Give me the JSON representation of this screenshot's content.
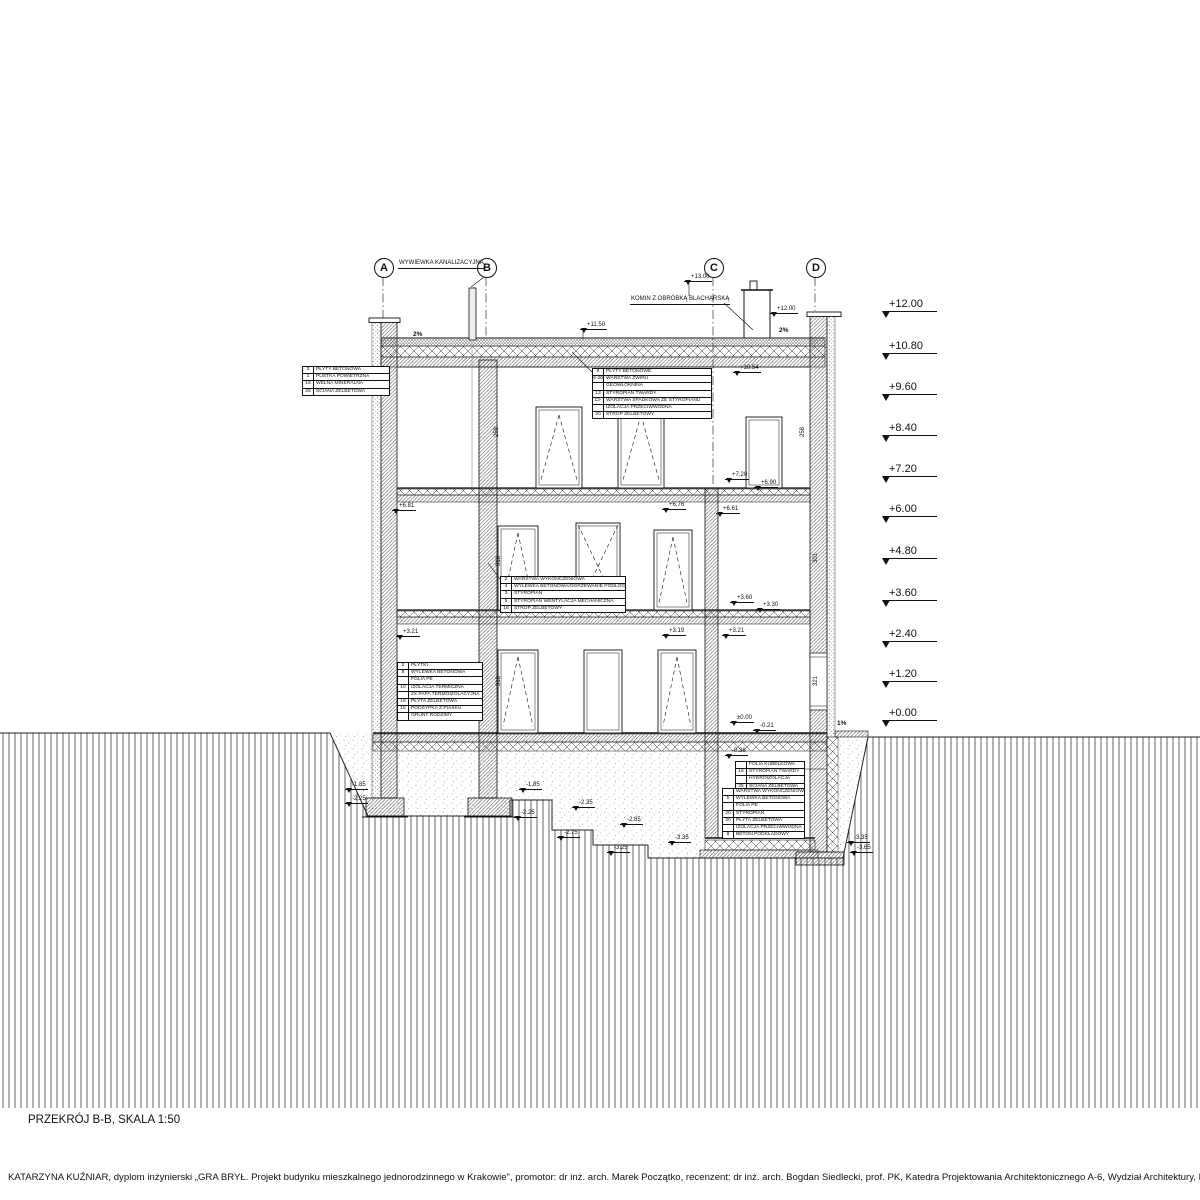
{
  "title": {
    "section": "PRZEKRÓJ B-B, SKALA 1:50",
    "credit": "KATARZYNA KUŹNIAR, dyplom inżynierski „GRA BRYŁ. Projekt budynku mieszkalnego jednorodzinnego w Krakowie\", promotor: dr inż. arch. Marek Początko, recenzent: dr inż. arch. Bogdan Siedlecki, prof. PK, Katedra Projektowania Architektonicznego A-6, Wydział Architektury, Politechnika Krakowska, rok akademicki 2023/2024"
  },
  "axes": [
    "A",
    "B",
    "C",
    "D"
  ],
  "elevation_scale": [
    "+12.00",
    "+10.80",
    "+9.60",
    "+8.40",
    "+7.20",
    "+6.00",
    "+4.80",
    "+3.60",
    "+2.40",
    "+1.20",
    "+0.00"
  ],
  "callouts": {
    "vent": "WYWIEWKA KANALIZACYJNA",
    "chimney": "KOMIN Z OBRÓBKĄ BLACHARSKĄ"
  },
  "marks": [
    "+13.00",
    "+12.00",
    "+11.50",
    "+10.54",
    "+7.20",
    "+6.90",
    "+6.81",
    "+6.76",
    "+6.61",
    "+3.60",
    "+3.30",
    "+3.21",
    "+3.19",
    "+3.21",
    "±0.00",
    "-0.21",
    "-0.36",
    "-1.85",
    "-2.25",
    "-1.85",
    "-2.25",
    "-2.35",
    "-2.75",
    "-2.85",
    "-3.25",
    "-3.35",
    "-3.10",
    "-3.35",
    "-3.65"
  ],
  "slopes": [
    "2%",
    "2%",
    "1%"
  ],
  "dims": [
    "258",
    "318",
    "318",
    "258",
    "301",
    "321"
  ],
  "tables": {
    "wall": {
      "rows": [
        {
          "n": "3",
          "t": "PŁYTY BETONOWA"
        },
        {
          "n": "1",
          "t": "PUSTKA POWIETRZNA"
        },
        {
          "n": "16",
          "t": "WEŁNA MINERALNA"
        },
        {
          "n": "25",
          "t": "ŚCIANA ŻELBETOWA"
        }
      ]
    },
    "roof": {
      "rows": [
        {
          "n": "8",
          "t": "PŁYTY BETONOWE"
        },
        {
          "n": "8-20",
          "t": "WARSTWA ŻWIRU"
        },
        {
          "n": "",
          "t": "GEOWŁÓKNINA"
        },
        {
          "n": "13",
          "t": "STYROPIAN TWARDY"
        },
        {
          "n": "13-24",
          "t": "WARSTWA SPADKOWA ZE STYROPIANU"
        },
        {
          "n": "",
          "t": "IZOLACJA PRZECIWWODNA"
        },
        {
          "n": "20",
          "t": "STROP ŻELBETOWY"
        }
      ]
    },
    "floor": {
      "rows": [
        {
          "n": "2",
          "t": "WARSTWA WYKOŃCZENIOWA"
        },
        {
          "n": "4",
          "t": "WYLEWKA BETONOWA/OGRZEWANIE PODŁOGOWE"
        },
        {
          "n": "3",
          "t": "STYROPIAN"
        },
        {
          "n": "5",
          "t": "STYROPIAN WENTYLACJA MECHANICZNA"
        },
        {
          "n": "18",
          "t": "STROP ŻELBETOWY"
        }
      ]
    },
    "ground": {
      "rows": [
        {
          "n": "2",
          "t": "PŁYTKI"
        },
        {
          "n": "8",
          "t": "WYLEWKA BETONOWA"
        },
        {
          "n": "",
          "t": "FOLIA PE"
        },
        {
          "n": "10",
          "t": "IZOLACJA TERMICZNA"
        },
        {
          "n": "",
          "t": "2X PAPA TERMOIZOLACYJNA"
        },
        {
          "n": "18",
          "t": "PŁYTA ŻELBETOWA"
        },
        {
          "n": "15",
          "t": "PODSYPKA Z PIASKU"
        },
        {
          "n": "",
          "t": "GRUNT RODZIMY"
        }
      ]
    },
    "bwall": {
      "rows": [
        {
          "n": "",
          "t": "FOLIA KUBEŁKOWA"
        },
        {
          "n": "16",
          "t": "STYROPIAN TWARDY"
        },
        {
          "n": "",
          "t": "HYDROIZOLACJA"
        },
        {
          "n": "25",
          "t": "ŚCIANA ŻELBETOWA"
        }
      ]
    },
    "bfloor": {
      "rows": [
        {
          "n": "",
          "t": "WARSTWA WYKOŃCZENIOWA"
        },
        {
          "n": "5",
          "t": "WYLEWKA BETONOWA"
        },
        {
          "n": "",
          "t": "FOLIA PE"
        },
        {
          "n": "20",
          "t": "STYROPIAN"
        },
        {
          "n": "30",
          "t": "PŁYTA ŻELBETOWA"
        },
        {
          "n": "",
          "t": "IZOLACJA PRZECIWWODNA"
        },
        {
          "n": "8",
          "t": "BETON PODKŁADOWY"
        }
      ]
    }
  }
}
